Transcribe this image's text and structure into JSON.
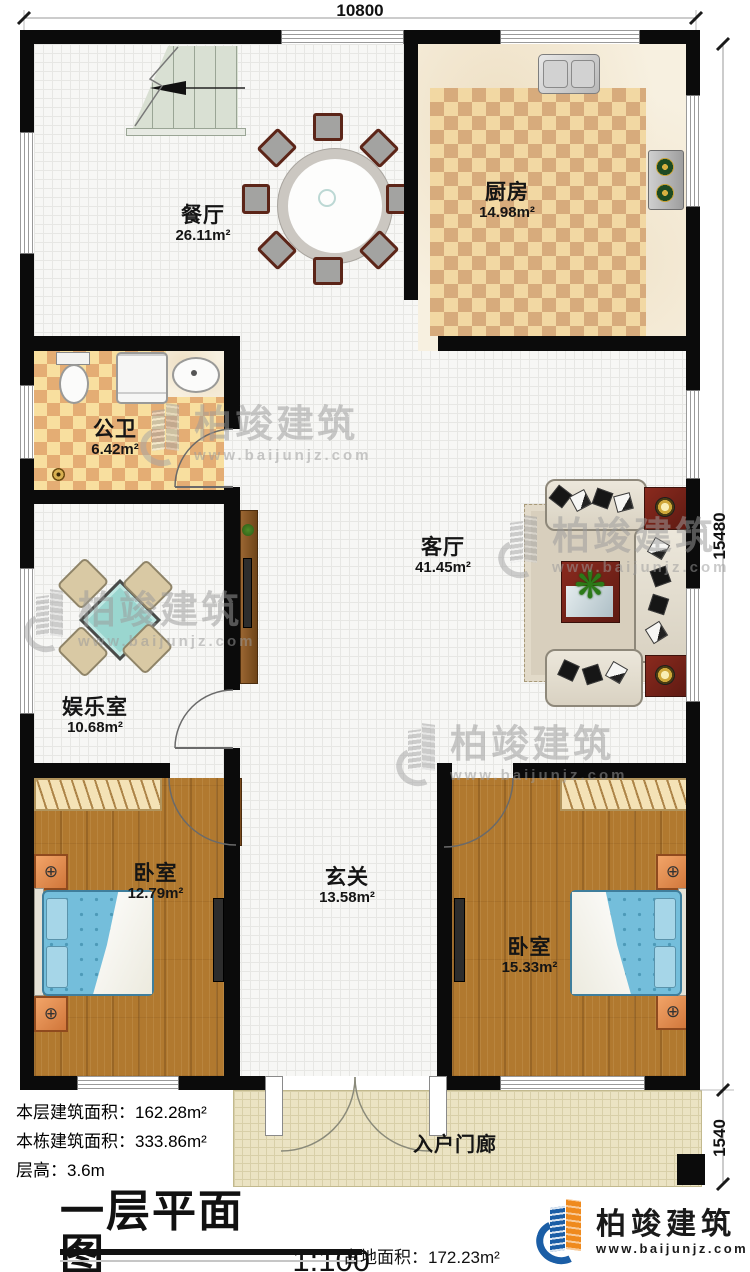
{
  "plan": {
    "dimensions": {
      "width_top": "10800",
      "height_main": "15480",
      "height_porch": "1540"
    },
    "rooms": [
      {
        "name": "餐厅",
        "area": "26.11m²"
      },
      {
        "name": "厨房",
        "area": "14.98m²"
      },
      {
        "name": "公卫",
        "area": "6.42m²"
      },
      {
        "name": "客厅",
        "area": "41.45m²"
      },
      {
        "name": "娱乐室",
        "area": "10.68m²"
      },
      {
        "name": "卧室",
        "area": "12.79m²"
      },
      {
        "name": "玄关",
        "area": "13.58m²"
      },
      {
        "name": "卧室",
        "area": "15.33m²"
      },
      {
        "name": "入户门廊",
        "area": ""
      }
    ]
  },
  "info": {
    "stats": [
      {
        "label": "本层建筑面积：",
        "value": "162.28m²"
      },
      {
        "label": "本栋建筑面积：",
        "value": "333.86m²"
      },
      {
        "label": "层高：",
        "value": "3.6m"
      }
    ],
    "title": "一层平面图",
    "scale": "1:100",
    "footprint_label": "占地面积：",
    "footprint_value": "172.23m²"
  },
  "brand": {
    "name": "柏竣建筑",
    "url": "www.baijunjz.com"
  },
  "watermark": {
    "name": "柏竣建筑",
    "url": "www.baijunjz.com"
  }
}
